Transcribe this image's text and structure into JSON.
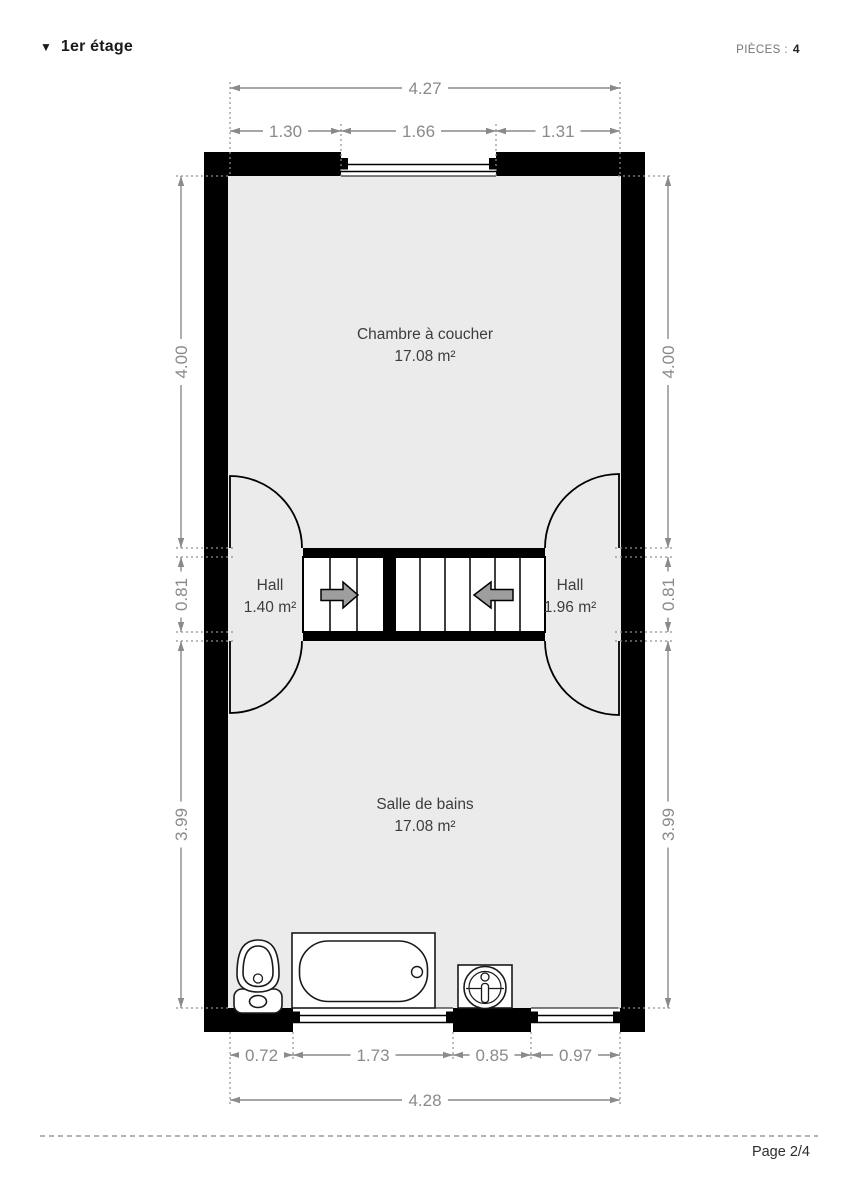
{
  "header": {
    "collapse_icon": "▼",
    "title": "1er étage",
    "pieces_label": "PIÈCES :",
    "pieces_value": "4"
  },
  "plan": {
    "rooms": [
      {
        "name": "Chambre à coucher",
        "area": "17.08 m²"
      },
      {
        "name": "Hall",
        "area": "1.40 m²"
      },
      {
        "name": "Hall",
        "area": "1.96 m²"
      },
      {
        "name": "Salle de bains",
        "area": "17.08 m²"
      }
    ],
    "dimensions": {
      "top": {
        "overall": "4.27",
        "segments": [
          "1.30",
          "1.66",
          "1.31"
        ]
      },
      "bottom": {
        "overall": "4.28",
        "segments": [
          "0.72",
          "1.73",
          "0.85",
          "0.97"
        ]
      },
      "left": [
        "4.00",
        "0.81",
        "3.99"
      ],
      "right": [
        "4.00",
        "0.81",
        "3.99"
      ]
    },
    "fixtures": [
      "toilet",
      "bathtub",
      "sink"
    ],
    "stairs": {
      "flights": 2,
      "direction_arrows": [
        "right",
        "left"
      ]
    },
    "colors": {
      "wall": "#000000",
      "floor": "#ebebeb",
      "dimension": "#8a8a8a",
      "room_label": "#3d3d3d",
      "stair_arrow": "#9e9e9e"
    }
  },
  "footer": {
    "page_label": "Page 2/4"
  }
}
